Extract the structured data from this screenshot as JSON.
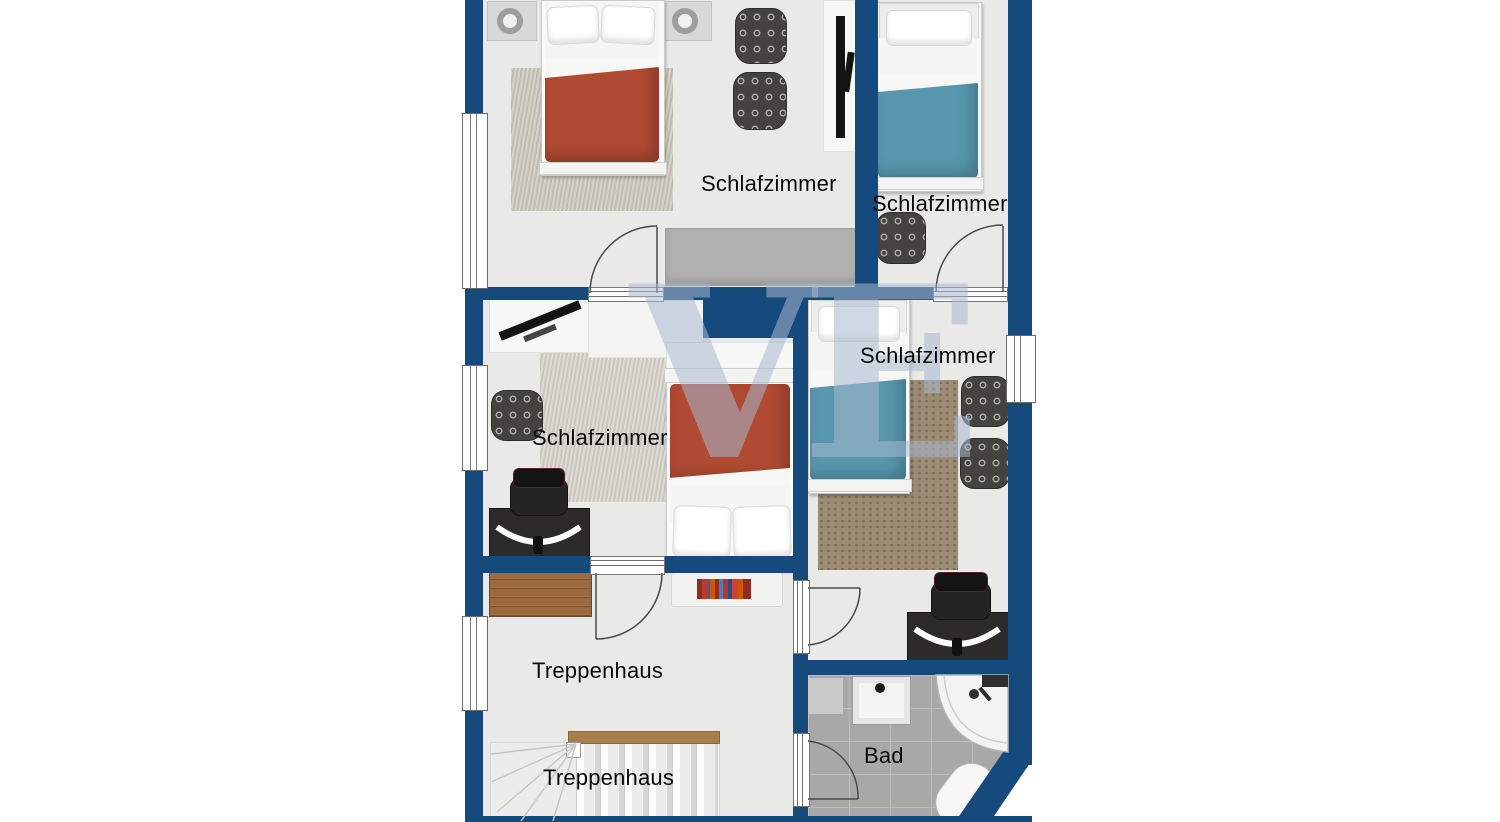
{
  "watermark": {
    "text": "VE"
  },
  "colors": {
    "wall": "#164a7c",
    "floor": "#e9e9e8",
    "tile": "#a8a8a7",
    "grout": "#bdbdbc",
    "duvet_red": "#b04a33",
    "duvet_blue": "#5897ae",
    "rug_beige": "#c9c5b7",
    "rug_light": "#d3d0c6",
    "rug_brown": "#9c8c74",
    "wood": "#9c6a3c",
    "handrail": "#a87f4a"
  },
  "rooms": {
    "bedroom_top_left": {
      "label": "Schlafzimmer"
    },
    "bedroom_top_right": {
      "label": "Schlafzimmer"
    },
    "bedroom_middle_left": {
      "label": "Schlafzimmer"
    },
    "bedroom_middle_right": {
      "label": "Schlafzimmer"
    },
    "staircase_hall": {
      "label": "Treppenhaus"
    },
    "staircase": {
      "label": "Treppenhaus"
    },
    "bathroom": {
      "label": "Bad"
    }
  }
}
